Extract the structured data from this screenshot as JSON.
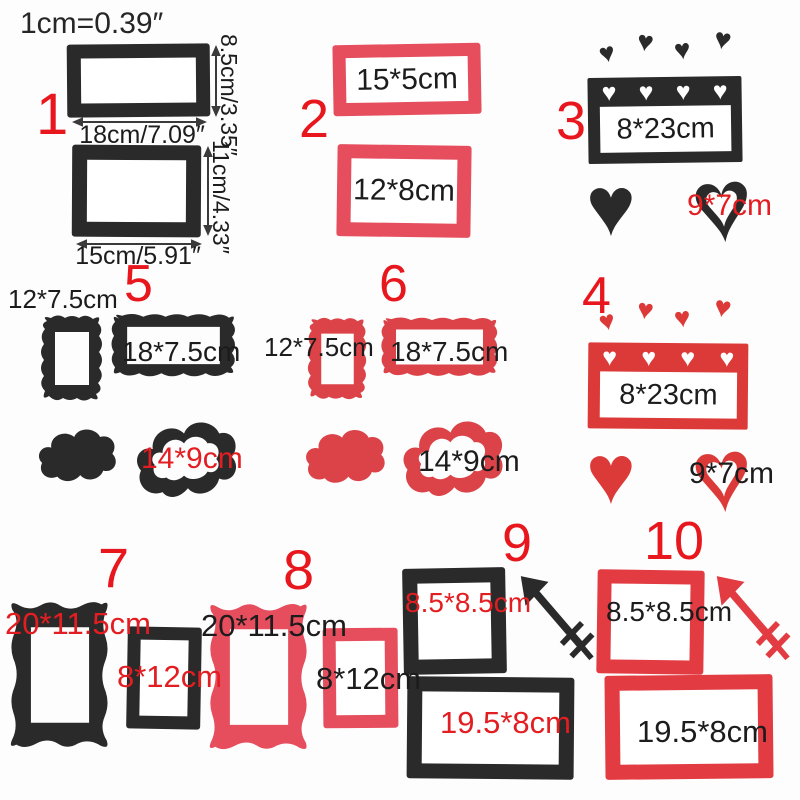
{
  "scale_note": "1cm=0.39″",
  "glyphs": {
    "heart": "♥"
  },
  "colors": {
    "felt_black": "#2a2a2a",
    "felt_red_pink": "#e64e5e",
    "felt_red": "#dc3a38",
    "felt_red_crimson": "#dc4348",
    "felt_red_bright": "#e23b42",
    "label_red": "#e31e22",
    "number_red": "#e8161d",
    "text_black": "#1c1c1c",
    "measure_gray": "#3a3a3a"
  },
  "items": {
    "i1": {
      "number": "1",
      "top_frame": {
        "width_label": "18cm/7.09″",
        "height_label": "8.5cm/3.35″"
      },
      "bottom_frame": {
        "width_label": "15cm/5.91″",
        "height_label": "11cm/4.33″"
      }
    },
    "i2": {
      "number": "2",
      "top_frame": "15*5cm",
      "bottom_frame": "12*8cm"
    },
    "i3": {
      "number": "3",
      "banner": "8*23cm",
      "heart_frame": "9*7cm"
    },
    "i4": {
      "number": "4",
      "banner": "8*23cm",
      "heart_frame": "9*7cm"
    },
    "i5": {
      "number": "5",
      "portrait_frame": "12*7.5cm",
      "landscape_frame": "18*7.5cm",
      "cloud_frame": "14*9cm"
    },
    "i6": {
      "number": "6",
      "portrait_frame": "12*7.5cm",
      "landscape_frame": "18*7.5cm",
      "cloud_frame": "14*9cm"
    },
    "i7": {
      "number": "7",
      "bracket_frame": "20*11.5cm",
      "small_frame": "8*12cm"
    },
    "i8": {
      "number": "8",
      "bracket_frame": "20*11.5cm",
      "small_frame": "8*12cm"
    },
    "i9": {
      "number": "9",
      "square_frame": "8.5*8.5cm",
      "wide_frame": "19.5*8cm"
    },
    "i10": {
      "number": "10",
      "square_frame": "8.5*8.5cm",
      "wide_frame": "19.5*8cm"
    }
  }
}
